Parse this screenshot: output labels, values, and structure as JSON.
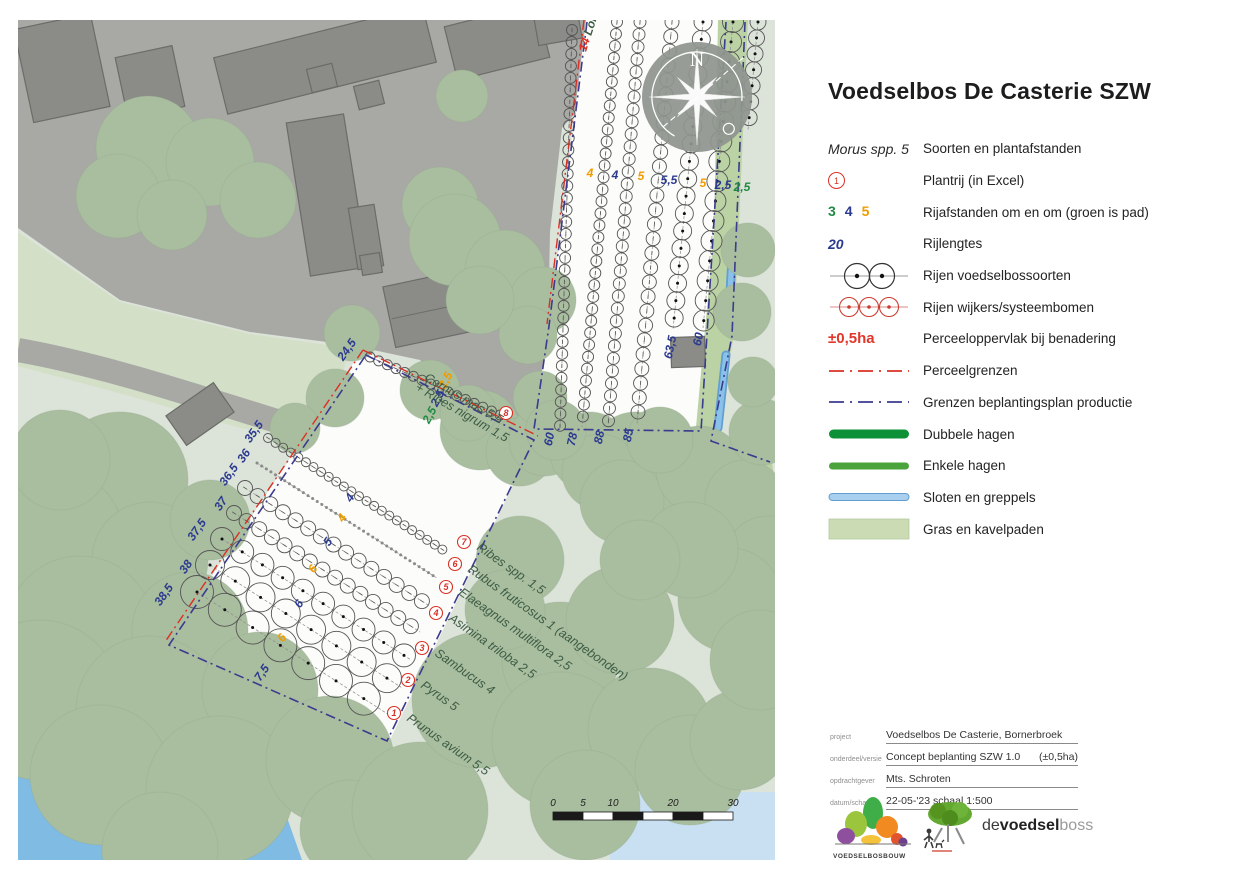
{
  "title": "Voedselbos De Casterie SZW",
  "colors": {
    "red": "#d93025",
    "blue": "#2b3a8f",
    "orange": "#f09c00",
    "green": "#1f8a44",
    "dgreen": "#3d5c44",
    "hedge_dark": "#0c9038",
    "hedge_light": "#4ba33c",
    "water": "#7fbbe3",
    "grass_swatch": "#cbdcb5",
    "ditch_fill": "#a9cfee",
    "ditch_edge": "#619fd2"
  },
  "legend": {
    "rows": [
      {
        "symbol": "species-text",
        "key": "Morus spp. 5",
        "label": "Soorten en plantafstanden"
      },
      {
        "symbol": "circled-number",
        "key": "1",
        "label": "Plantrij (in Excel)"
      },
      {
        "symbol": "colored-numbers",
        "keys": [
          "3",
          "4",
          "5"
        ],
        "key_colors": [
          "green",
          "blue",
          "orange"
        ],
        "label": "Rijafstanden om en om (groen is pad)"
      },
      {
        "symbol": "row-length",
        "key": "20",
        "label": "Rijlengtes"
      },
      {
        "symbol": "black-tree-row",
        "label": "Rijen voedselbossoorten"
      },
      {
        "symbol": "red-tree-row",
        "label": "Rijen wijkers/systeembomen"
      },
      {
        "symbol": "area-value",
        "key": "±0,5ha",
        "label": "Perceeloppervlak bij benadering"
      },
      {
        "symbol": "dashdot-red",
        "label": "Perceelgrenzen"
      },
      {
        "symbol": "dashdot-indigo",
        "label": "Grenzen beplantingsplan productie"
      },
      {
        "symbol": "bar-darkgreen",
        "label": "Dubbele hagen"
      },
      {
        "symbol": "bar-green",
        "label": "Enkele hagen"
      },
      {
        "symbol": "bar-blue",
        "label": "Sloten en greppels"
      },
      {
        "symbol": "swatch-lightgreen",
        "label": "Gras en kavelpaden"
      }
    ]
  },
  "project_table": {
    "rows": [
      {
        "label": "project",
        "value": "Voedselbos De Casterie, Bornerbroek",
        "extra": ""
      },
      {
        "label": "onderdeel/versie",
        "value": "Concept beplanting SZW 1.0",
        "extra": "(±0,5ha)"
      },
      {
        "label": "opdrachtgever",
        "value": "Mts. Schroten",
        "extra": ""
      },
      {
        "label": "datum/schaal",
        "value": "22-05-'23  schaal 1:500",
        "extra": ""
      }
    ]
  },
  "logos": {
    "left_text": "VOEDSELBOSBOUW",
    "brand": {
      "part1": "de",
      "part2": "voedsel",
      "part3": "boss"
    }
  },
  "map": {
    "compass_label": "N",
    "scalebar": {
      "ticks": [
        "0",
        "5",
        "10",
        "20",
        "30"
      ]
    },
    "plant_rows": [
      {
        "num": "1",
        "name": "Prunus avium 5,5"
      },
      {
        "num": "2",
        "name": "Pyrus 5"
      },
      {
        "num": "3",
        "name": "Sambucus 4"
      },
      {
        "num": "4",
        "name": "Asimina triloba 2,5"
      },
      {
        "num": "5",
        "name": "Elaeagnus multiflora 2,5"
      },
      {
        "num": "6",
        "name": "Rubus fruticosus 1 (aangebonden)"
      },
      {
        "num": "7",
        "name": "Ribes spp. 1,5"
      },
      {
        "num": "8",
        "name": "Cornus mas 5,5",
        "name2": "+ Ribes nigrum 1,5"
      }
    ],
    "partial_row_label": {
      "parts": [
        {
          "t": "14 ",
          "c": "red"
        },
        {
          "t": "Lon",
          "c": "dgreen"
        }
      ],
      "x": 586,
      "y": 52,
      "rot": -72
    },
    "labels": [
      {
        "t": "4",
        "x": 590,
        "y": 177,
        "rot": 0,
        "c": "orange"
      },
      {
        "t": "4",
        "x": 615,
        "y": 179,
        "rot": 0,
        "c": "blue"
      },
      {
        "t": "5",
        "x": 641,
        "y": 180,
        "rot": 0,
        "c": "orange"
      },
      {
        "t": "5,5",
        "x": 669,
        "y": 184,
        "rot": 0,
        "c": "blue"
      },
      {
        "t": "5",
        "x": 703,
        "y": 187,
        "rot": 0,
        "c": "orange"
      },
      {
        "t": "2,5",
        "x": 723,
        "y": 189,
        "rot": 0,
        "c": "blue"
      },
      {
        "t": "2,5",
        "x": 742,
        "y": 191,
        "rot": 0,
        "c": "green"
      },
      {
        "t": "60",
        "x": 553,
        "y": 440,
        "rot": -78,
        "c": "blue"
      },
      {
        "t": "78",
        "x": 576,
        "y": 440,
        "rot": -78,
        "c": "blue"
      },
      {
        "t": "88",
        "x": 603,
        "y": 438,
        "rot": -78,
        "c": "blue"
      },
      {
        "t": "85",
        "x": 632,
        "y": 436,
        "rot": -78,
        "c": "blue"
      },
      {
        "t": "63,5",
        "x": 674,
        "y": 348,
        "rot": -78,
        "c": "blue"
      },
      {
        "t": "60",
        "x": 702,
        "y": 340,
        "rot": -78,
        "c": "blue"
      },
      {
        "t": "2,5",
        "x": 433,
        "y": 417,
        "rot": -62,
        "c": "green"
      },
      {
        "t": "2,5",
        "x": 441,
        "y": 400,
        "rot": -62,
        "c": "blue"
      },
      {
        "t": "2,5",
        "x": 449,
        "y": 382,
        "rot": -62,
        "c": "orange"
      },
      {
        "t": "24,5",
        "x": 350,
        "y": 352,
        "rot": -55,
        "c": "blue"
      },
      {
        "t": "35,5",
        "x": 257,
        "y": 434,
        "rot": -55,
        "c": "blue"
      },
      {
        "t": "36",
        "x": 247,
        "y": 458,
        "rot": -55,
        "c": "blue"
      },
      {
        "t": "36,5",
        "x": 232,
        "y": 477,
        "rot": -55,
        "c": "blue"
      },
      {
        "t": "37",
        "x": 224,
        "y": 506,
        "rot": -55,
        "c": "blue"
      },
      {
        "t": "37,5",
        "x": 200,
        "y": 532,
        "rot": -55,
        "c": "blue"
      },
      {
        "t": "38",
        "x": 189,
        "y": 569,
        "rot": -55,
        "c": "blue"
      },
      {
        "t": "38,5",
        "x": 167,
        "y": 597,
        "rot": -55,
        "c": "blue"
      },
      {
        "t": "7,5",
        "x": 265,
        "y": 675,
        "rot": -55,
        "c": "blue"
      },
      {
        "t": "4",
        "x": 353,
        "y": 500,
        "rot": -55,
        "c": "blue"
      },
      {
        "t": "4",
        "x": 345,
        "y": 520,
        "rot": -55,
        "c": "orange"
      },
      {
        "t": "5",
        "x": 331,
        "y": 544,
        "rot": -55,
        "c": "blue"
      },
      {
        "t": "6",
        "x": 316,
        "y": 571,
        "rot": -55,
        "c": "orange"
      },
      {
        "t": "6",
        "x": 302,
        "y": 606,
        "rot": -55,
        "c": "blue"
      },
      {
        "t": "6",
        "x": 285,
        "y": 640,
        "rot": -55,
        "c": "orange"
      }
    ]
  }
}
